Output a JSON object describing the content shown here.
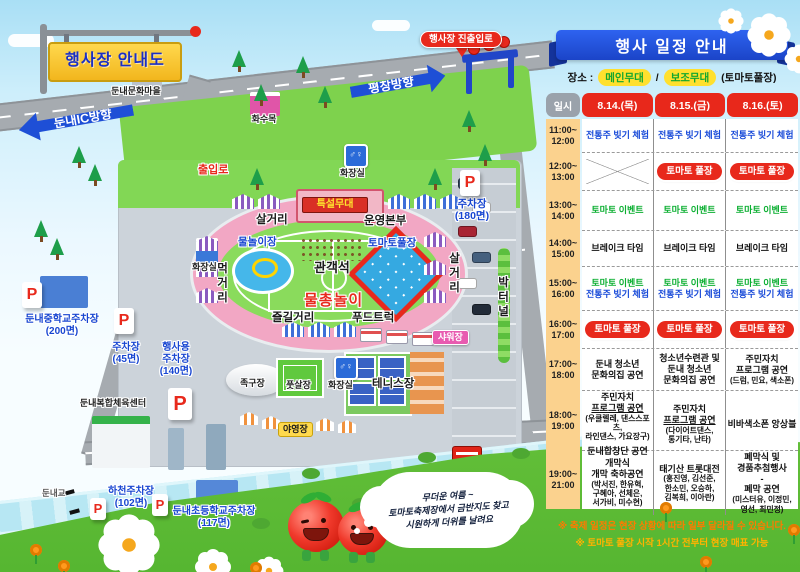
{
  "map": {
    "signboard_title": "행사장 안내도",
    "icons": {
      "restroom": "♂♀"
    },
    "bubble_lines": [
      "무더운 여름 ~",
      "토마토축제장에서 금반지도 찾고",
      "시원하게 더위를 날려요"
    ],
    "labels": [
      {
        "id": "culture-village-label",
        "text": "둔내문화마을",
        "cls": "plain",
        "x": 98,
        "y": 86,
        "w": 76
      },
      {
        "id": "hwasumok-label",
        "text": "화수목",
        "cls": "plain",
        "x": 240,
        "y": 114,
        "w": 48
      },
      {
        "id": "dunnae-ic-arrow",
        "text": "둔내IC방향",
        "cls": "arrow arrow-left",
        "x": 18,
        "y": 106,
        "w": 102,
        "rot": -10
      },
      {
        "id": "pyeongchang-arrow",
        "text": "평창방향",
        "cls": "arrow arrow-right",
        "x": 350,
        "y": 70,
        "w": 82,
        "rot": -10
      },
      {
        "id": "entrance-road-sign",
        "text": "행사장 진출입로",
        "cls": "red-pill",
        "x": 420,
        "y": 31
      },
      {
        "id": "entry-label",
        "text": "출입로",
        "cls": "red-outline",
        "x": 198,
        "y": 164
      },
      {
        "id": "restroom-top-label",
        "text": "화장실",
        "cls": "plain",
        "x": 340,
        "y": 168
      },
      {
        "id": "parking-180-label",
        "lines": [
          "주차장",
          "(180면)"
        ],
        "cls": "blue",
        "x": 444,
        "y": 198,
        "w": 56
      },
      {
        "id": "salgeori-top-label",
        "text": "살거리",
        "cls": "area",
        "x": 256,
        "y": 214
      },
      {
        "id": "stage-label",
        "text": "특설무대",
        "cls": "stagelbl",
        "x": 302,
        "y": 197,
        "w": 64
      },
      {
        "id": "ops-label",
        "text": "운영본부",
        "cls": "area",
        "x": 364,
        "y": 215
      },
      {
        "id": "waterplay-label",
        "text": "물놀이장",
        "cls": "blue",
        "x": 238,
        "y": 236
      },
      {
        "id": "tomato-pool-label",
        "text": "토마토풀장",
        "cls": "blue",
        "x": 368,
        "y": 237
      },
      {
        "id": "audience-label",
        "text": "관객석",
        "cls": "area lg",
        "x": 314,
        "y": 260
      },
      {
        "id": "watergun-label",
        "text": "물총놀이",
        "cls": "red-lg",
        "x": 304,
        "y": 292
      },
      {
        "id": "meokgeori-label",
        "text": "먹거리",
        "cls": "area vert",
        "x": 214,
        "y": 262
      },
      {
        "id": "salgeori-right-label",
        "text": "살거리",
        "cls": "area vert",
        "x": 446,
        "y": 252
      },
      {
        "id": "bakteonel-label",
        "text": "박터널",
        "cls": "area vert",
        "x": 495,
        "y": 276
      },
      {
        "id": "jeulgil-label",
        "text": "즐길거리",
        "cls": "area",
        "x": 272,
        "y": 312
      },
      {
        "id": "foodtruck-label",
        "text": "푸드트럭",
        "cls": "area",
        "x": 352,
        "y": 312
      },
      {
        "id": "shower-label",
        "text": "샤워장",
        "cls": "shower",
        "x": 432,
        "y": 330
      },
      {
        "id": "restroom-left-label",
        "text": "화장실",
        "cls": "plain",
        "x": 192,
        "y": 262
      },
      {
        "id": "school-parking-label",
        "lines": [
          "둔내중학교주차장",
          "(200면)"
        ],
        "cls": "blue md",
        "x": 10,
        "y": 314,
        "w": 104
      },
      {
        "id": "parking-45-label",
        "lines": [
          "주차장",
          "(45면)"
        ],
        "cls": "blue md",
        "x": 102,
        "y": 342,
        "w": 48
      },
      {
        "id": "event-parking-label",
        "lines": [
          "행사용",
          "주차장",
          "(140면)"
        ],
        "cls": "blue md",
        "x": 150,
        "y": 342,
        "w": 52
      },
      {
        "id": "sports-center-label",
        "text": "둔내복합체육센터",
        "cls": "plain",
        "x": 66,
        "y": 398,
        "w": 94
      },
      {
        "id": "jokgu-label",
        "text": "족구장",
        "cls": "plain",
        "x": 240,
        "y": 378
      },
      {
        "id": "futsal-label",
        "text": "풋살장",
        "cls": "plain",
        "x": 286,
        "y": 380
      },
      {
        "id": "restroom-mid-label",
        "text": "화장실",
        "cls": "plain",
        "x": 328,
        "y": 380
      },
      {
        "id": "tennis-label",
        "text": "테니스장",
        "cls": "area",
        "x": 372,
        "y": 378
      },
      {
        "id": "camping-label",
        "text": "야영장",
        "cls": "camp",
        "x": 278,
        "y": 422
      },
      {
        "id": "river-parking-label",
        "lines": [
          "하천주차장",
          "(102면)"
        ],
        "cls": "blue md",
        "x": 96,
        "y": 486,
        "w": 70
      },
      {
        "id": "elem-parking-label",
        "lines": [
          "둔내초등학교주차장",
          "(117면)"
        ],
        "cls": "blue md",
        "x": 156,
        "y": 506,
        "w": 116
      },
      {
        "id": "bridge-label",
        "text": "둔내교",
        "cls": "plain sm-gray",
        "x": 42,
        "y": 488
      },
      {
        "id": "p-parking-180",
        "text": "P",
        "cls": "p-mark",
        "x": 460,
        "y": 170
      },
      {
        "id": "p-school",
        "text": "P",
        "cls": "p-mark",
        "x": 22,
        "y": 282
      },
      {
        "id": "p-45",
        "text": "P",
        "cls": "p-mark",
        "x": 114,
        "y": 308
      },
      {
        "id": "p-event",
        "text": "P",
        "cls": "p-mark plg",
        "x": 168,
        "y": 388
      },
      {
        "id": "p-river",
        "text": "P",
        "cls": "p-mark psm",
        "x": 90,
        "y": 498
      },
      {
        "id": "p-elem",
        "text": "P",
        "cls": "p-mark psm",
        "x": 152,
        "y": 494
      }
    ]
  },
  "schedule": {
    "title": "행사 일정 안내",
    "location_label": "장소 :",
    "venues": [
      "메인무대",
      "보조무대"
    ],
    "venue_sep": "/",
    "venue_note": "(토마토풀장)",
    "col_time": "일시",
    "days": [
      "8.14.(목)",
      "8.15.(금)",
      "8.16.(토)"
    ],
    "rows": [
      {
        "time": [
          "11:00~",
          "12:00"
        ],
        "h": 34,
        "cells": [
          {
            "kind": "lines",
            "lines": [
              {
                "t": "전통주 빚기 체험",
                "cls": "c-blue"
              }
            ]
          },
          {
            "kind": "lines",
            "lines": [
              {
                "t": "전통주 빚기 체험",
                "cls": "c-blue"
              }
            ]
          },
          {
            "kind": "lines",
            "lines": [
              {
                "t": "전통주 빚기 체험",
                "cls": "c-blue"
              }
            ]
          }
        ]
      },
      {
        "time": [
          "12:00~",
          "13:00"
        ],
        "h": 38,
        "cells": [
          {
            "kind": "cross"
          },
          {
            "kind": "pill",
            "t": "토마토 풀장"
          },
          {
            "kind": "pill",
            "t": "토마토 풀장"
          }
        ]
      },
      {
        "time": [
          "13:00~",
          "14:00"
        ],
        "h": 40,
        "cells": [
          {
            "kind": "lines",
            "lines": [
              {
                "t": "토마토 이벤트",
                "cls": "c-green"
              }
            ]
          },
          {
            "kind": "lines",
            "lines": [
              {
                "t": "토마토 이벤트",
                "cls": "c-green"
              }
            ]
          },
          {
            "kind": "lines",
            "lines": [
              {
                "t": "토마토 이벤트",
                "cls": "c-green"
              }
            ]
          }
        ]
      },
      {
        "time": [
          "14:00~",
          "15:00"
        ],
        "h": 36,
        "cells": [
          {
            "kind": "lines",
            "lines": [
              {
                "t": "브레이크 타임"
              }
            ]
          },
          {
            "kind": "lines",
            "lines": [
              {
                "t": "브레이크 타임"
              }
            ]
          },
          {
            "kind": "lines",
            "lines": [
              {
                "t": "브레이크 타임"
              }
            ]
          }
        ]
      },
      {
        "time": [
          "15:00~",
          "16:00"
        ],
        "h": 44,
        "cells": [
          {
            "kind": "lines",
            "lines": [
              {
                "t": "토마토 이벤트",
                "cls": "c-green"
              },
              {
                "t": "전통주 빚기 체험",
                "cls": "c-blue"
              }
            ]
          },
          {
            "kind": "lines",
            "lines": [
              {
                "t": "토마토 이벤트",
                "cls": "c-green"
              },
              {
                "t": "전통주 빚기 체험",
                "cls": "c-blue"
              }
            ]
          },
          {
            "kind": "lines",
            "lines": [
              {
                "t": "토마토 이벤트",
                "cls": "c-green"
              },
              {
                "t": "전통주 빚기 체험",
                "cls": "c-blue"
              }
            ]
          }
        ]
      },
      {
        "time": [
          "16:00~",
          "17:00"
        ],
        "h": 38,
        "cells": [
          {
            "kind": "pill",
            "t": "토마토 풀장"
          },
          {
            "kind": "pill",
            "t": "토마토 풀장"
          },
          {
            "kind": "pill",
            "t": "토마토 풀장"
          }
        ]
      },
      {
        "time": [
          "17:00~",
          "18:00"
        ],
        "h": 42,
        "cells": [
          {
            "kind": "lines",
            "lines": [
              {
                "t": "둔내 청소년"
              },
              {
                "t": "문화의집 공연"
              }
            ]
          },
          {
            "kind": "lines",
            "lines": [
              {
                "t": "청소년수련관 및"
              },
              {
                "t": "둔내 청소년"
              },
              {
                "t": "문화의집 공연"
              }
            ]
          },
          {
            "kind": "lines",
            "lines": [
              {
                "t": "주민자치"
              },
              {
                "t": "프로그램 공연"
              },
              {
                "t": "(드럼, 민요, 색소폰)",
                "cls": "sm"
              }
            ]
          }
        ]
      },
      {
        "time": [
          "18:00~",
          "19:00"
        ],
        "h": 60,
        "cells": [
          {
            "kind": "lines",
            "lines": [
              {
                "t": "주민자치"
              },
              {
                "t": "프로그램 공연",
                "cls": "u"
              },
              {
                "t": "(우쿨렐레, 댄스스포츠,",
                "cls": "sm"
              },
              {
                "t": "라인댄스, 가요장구)",
                "cls": "sm"
              },
              {
                "t": " ",
                "cls": "gap"
              },
              {
                "t": "둔내합창단 공연"
              }
            ]
          },
          {
            "kind": "lines",
            "lines": [
              {
                "t": "주민자치"
              },
              {
                "t": "프로그램 공연",
                "cls": "u"
              },
              {
                "t": "(다이어트댄스,",
                "cls": "sm"
              },
              {
                "t": "통기타, 난타)",
                "cls": "sm"
              }
            ]
          },
          {
            "kind": "lines",
            "lines": [
              {
                "t": "비바색소폰 앙상블"
              }
            ]
          }
        ]
      },
      {
        "time": [
          "19:00~",
          "21:00"
        ],
        "h": 58,
        "cells": [
          {
            "kind": "lines",
            "lines": [
              {
                "t": "개막식"
              },
              {
                "t": "개막 축하공연"
              },
              {
                "t": "(박서진, 한유혁,",
                "cls": "sm"
              },
              {
                "t": "구혜아, 선체은,",
                "cls": "sm"
              },
              {
                "t": "서가비, 미수현)",
                "cls": "sm"
              }
            ]
          },
          {
            "kind": "lines",
            "lines": [
              {
                "t": "태기산 트롯대전"
              },
              {
                "t": "(홍진영, 김선준,",
                "cls": "sm"
              },
              {
                "t": "한소민, 오승하,",
                "cls": "sm"
              },
              {
                "t": "김복희, 이아란)",
                "cls": "sm"
              }
            ]
          },
          {
            "kind": "lines",
            "lines": [
              {
                "t": "폐막식 및"
              },
              {
                "t": "경품추첨행사"
              },
              {
                "t": "-"
              },
              {
                "t": "폐막 공연"
              },
              {
                "t": "(미스터유, 이정민,",
                "cls": "sm"
              },
              {
                "t": "영선, 최민정)",
                "cls": "sm"
              }
            ]
          }
        ]
      }
    ],
    "notes": [
      "※ 축제 일정은 현장 상황에 따라 일부 달라질 수 있습니다.",
      "※ 토마토 풀장 시작 1시간 전부터 현장 매표 가능"
    ]
  }
}
